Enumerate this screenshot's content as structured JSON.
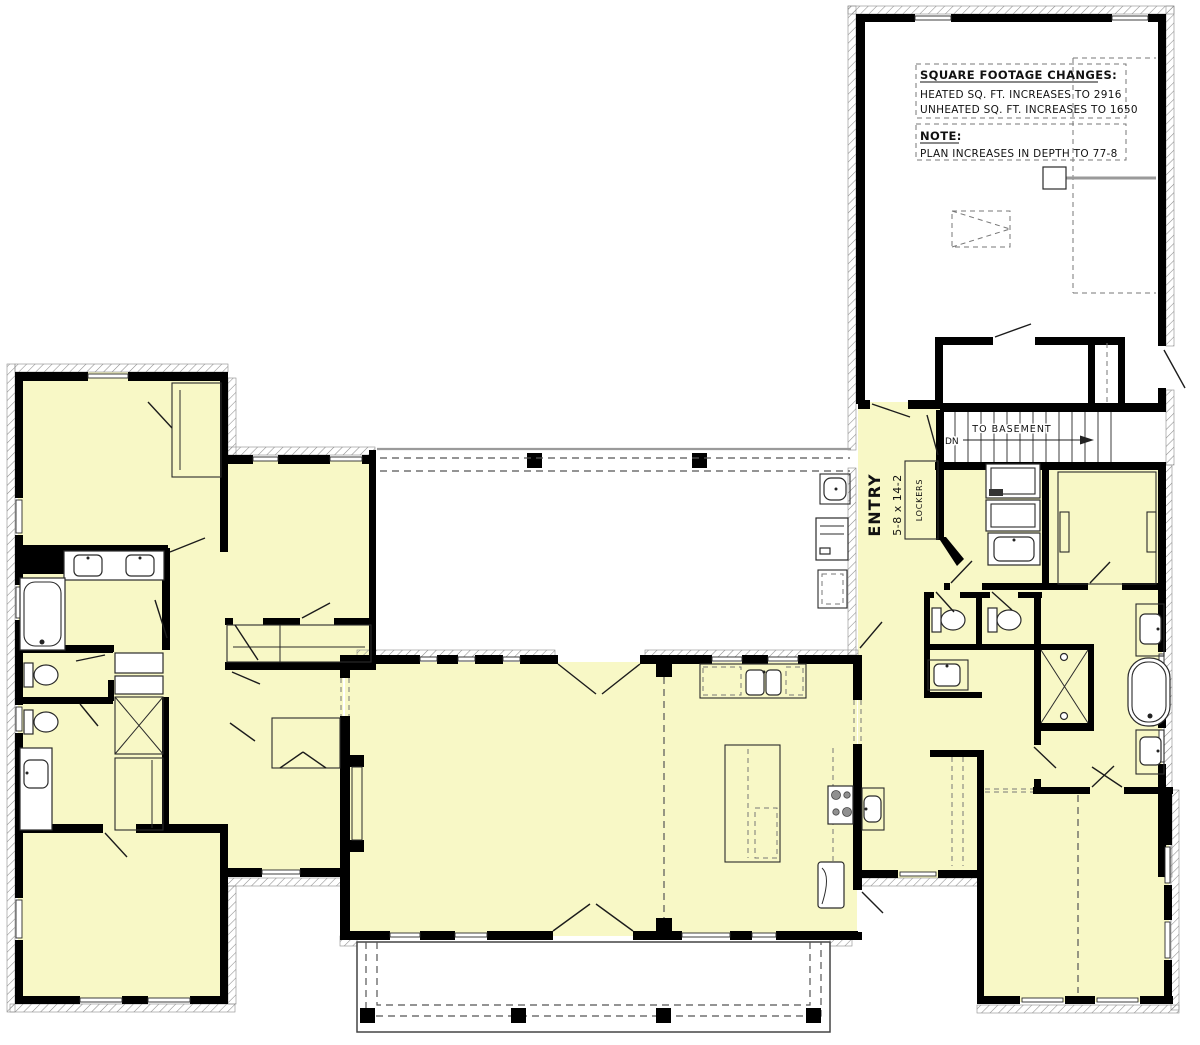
{
  "plan": {
    "notes": {
      "sqft_title": "SQUARE FOOTAGE CHANGES:",
      "sqft_line1": "HEATED SQ. FT. INCREASES TO 2916",
      "sqft_line2": "UNHEATED SQ. FT. INCREASES TO 1650",
      "note_title": "NOTE:",
      "note_line1": "PLAN INCREASES IN DEPTH TO 77-8"
    },
    "labels": {
      "entry_name": "ENTRY",
      "entry_dims": "5-8 x 14-2",
      "lockers": "LOCKERS",
      "stairs_direction": "DN",
      "stairs_destination": "TO BASEMENT"
    },
    "colors": {
      "room_fill": "#f8f8c6",
      "wall": "#000000",
      "hatch_line": "#8b8b8b",
      "dash_line": "#555555"
    }
  }
}
